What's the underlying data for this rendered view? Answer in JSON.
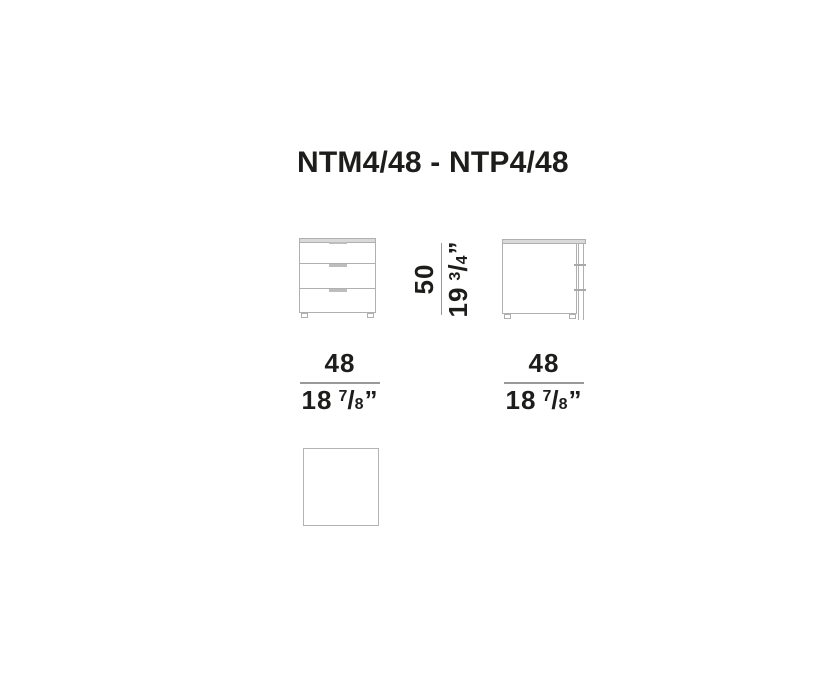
{
  "title": "NTM4/48 - NTP4/48",
  "colors": {
    "text": "#1d1d1b",
    "outline": "#b0b0b0",
    "panel_fill": "#d9d9d9",
    "handle_fill": "#bdbdbd",
    "dim_line": "#999999"
  },
  "dimensions": {
    "height": {
      "cm": "50",
      "in_whole": "19",
      "in_num": "3",
      "in_slash": "/",
      "in_den": "4",
      "in_unit": "”"
    },
    "width_front": {
      "cm": "48",
      "in_whole": "18",
      "in_num": "7",
      "in_slash": "/",
      "in_den": "8",
      "in_unit": "”"
    },
    "width_side": {
      "cm": "48",
      "in_whole": "18",
      "in_num": "7",
      "in_slash": "/",
      "in_den": "8",
      "in_unit": "”"
    }
  }
}
